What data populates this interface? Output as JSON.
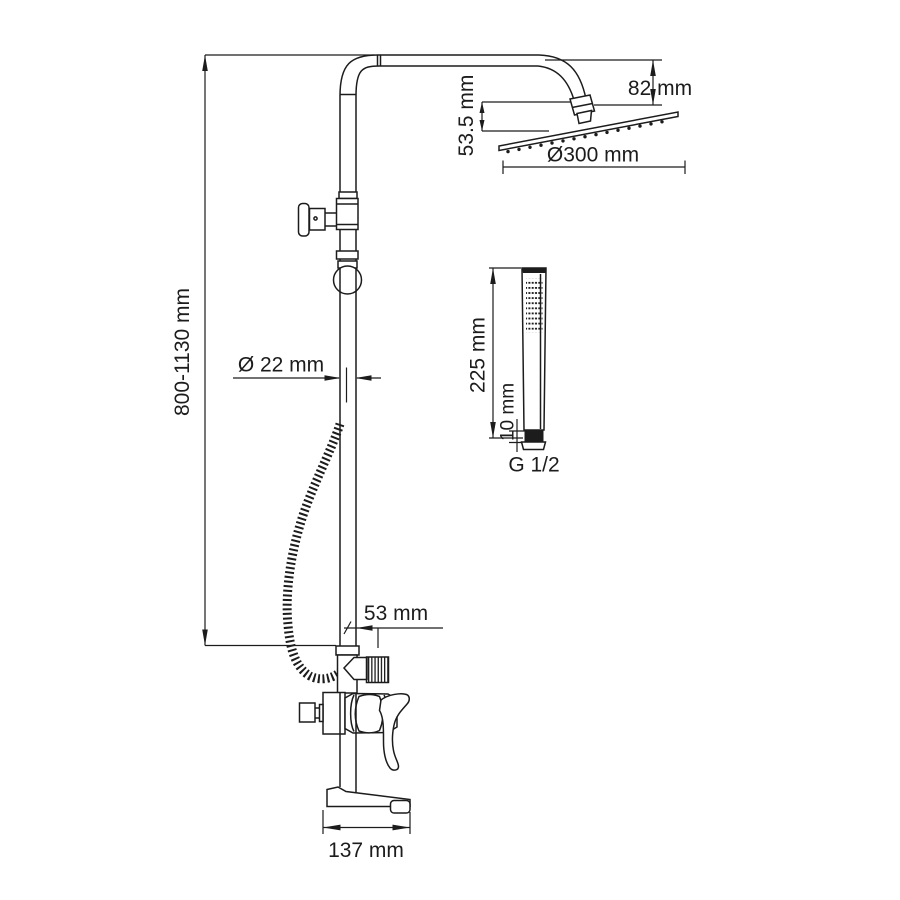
{
  "diagram": {
    "type": "technical-dimension-drawing",
    "subject": "thermostatic shower column with overhead rain shower, hand shower and bath mixer",
    "background_color": "#ffffff",
    "line_color": "#1c1c1c",
    "labels": {
      "column_height": "800-1130 mm",
      "head_offset": "82 mm",
      "head_drop": "53.5 mm",
      "head_diameter": "Ø300 mm",
      "pipe_diameter": "Ø 22 mm",
      "handshower_length": "225 mm",
      "handshower_connector": "10 mm",
      "thread_size": "G 1/2",
      "outlet_offset": "53 mm",
      "spout_length": "137 mm"
    }
  }
}
